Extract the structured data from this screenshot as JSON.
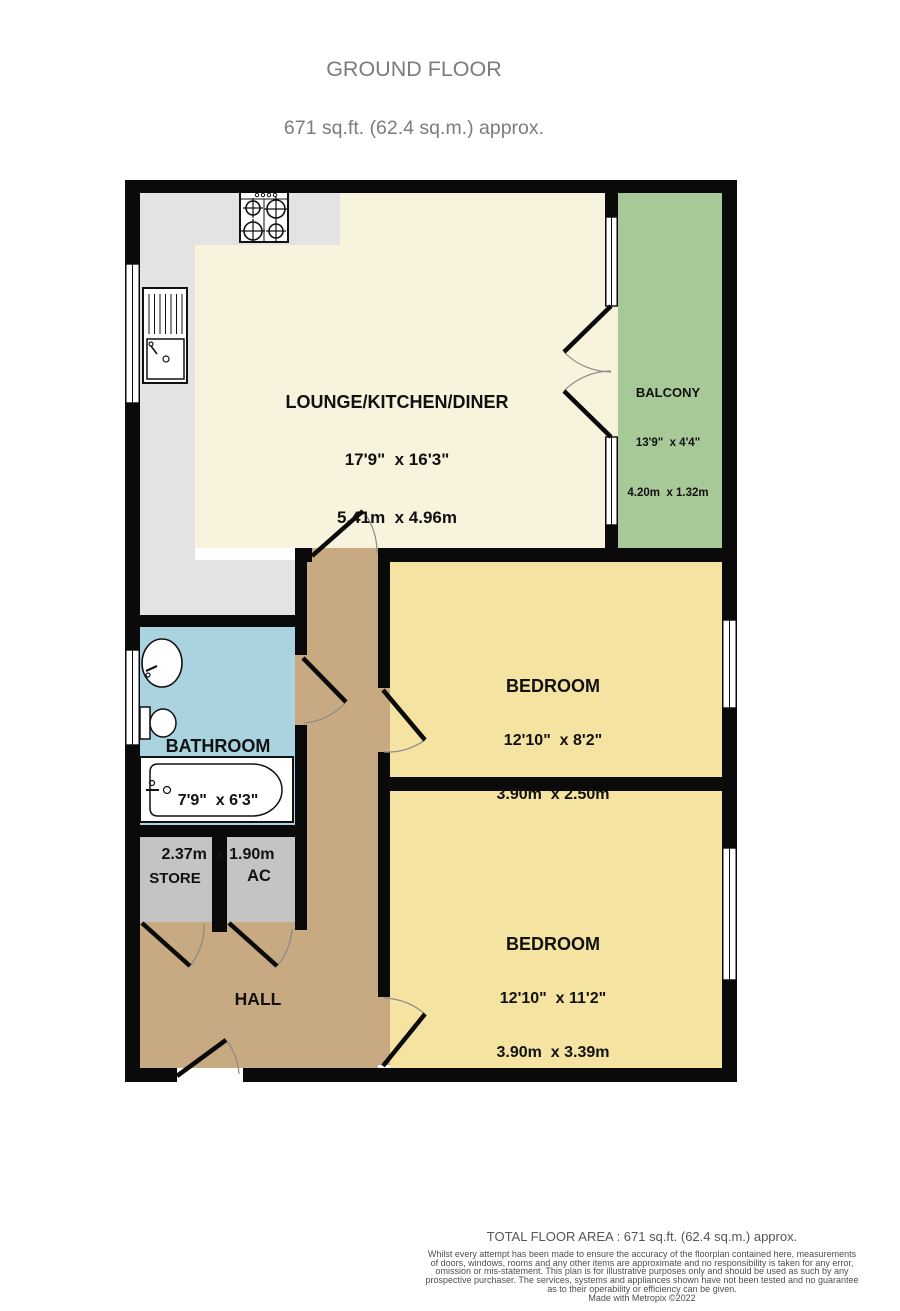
{
  "title": {
    "line1": "GROUND FLOOR",
    "line2": "671 sq.ft. (62.4 sq.m.) approx."
  },
  "rooms": {
    "lounge": {
      "name": "LOUNGE/KITCHEN/DINER",
      "imperial": "17'9\"  x 16'3\"",
      "metric": "5.41m  x 4.96m"
    },
    "balcony": {
      "name": "BALCONY",
      "imperial": "13'9\"  x 4'4\"",
      "metric": "4.20m  x 1.32m"
    },
    "bedroom1": {
      "name": "BEDROOM",
      "imperial": "12'10\"  x 8'2\"",
      "metric": "3.90m  x 2.50m"
    },
    "bedroom2": {
      "name": "BEDROOM",
      "imperial": "12'10\"  x 11'2\"",
      "metric": "3.90m  x 3.39m"
    },
    "bathroom": {
      "name": "BATHROOM",
      "imperial": "7'9\"  x 6'3\"",
      "metric": "2.37m  x 1.90m"
    },
    "store": {
      "name": "STORE"
    },
    "ac": {
      "name": "AC"
    },
    "hall": {
      "name": "HALL"
    }
  },
  "footer": {
    "total": "TOTAL FLOOR AREA : 671 sq.ft. (62.4 sq.m.) approx.",
    "disclaimer": [
      "Whilst every attempt has been made to ensure the accuracy of the floorplan contained here, measurements",
      "of doors, windows, rooms and any other items are approximate and no responsibility is taken for any error,",
      "omission or mis-statement. This plan is for illustrative purposes only and should be used as such by any",
      "prospective purchaser. The services, systems and appliances shown have not been tested and no guarantee",
      "as to their operability or efficiency can be given."
    ],
    "credit": "Made with Metropix ©2022"
  },
  "colors": {
    "wall": "#0a0a0a",
    "lounge_floor": "#f8f3dc",
    "kitchen_floor": "#e3e3e3",
    "balcony_floor": "#a7c897",
    "bedroom_floor": "#f5e3a1",
    "bathroom_floor": "#a9d3de",
    "hall_floor": "#c7a982",
    "store_floor": "#c4c4c4",
    "window": "#ffffff",
    "title_text": "#7c7c7c",
    "footer_text": "#4e4e4e"
  }
}
